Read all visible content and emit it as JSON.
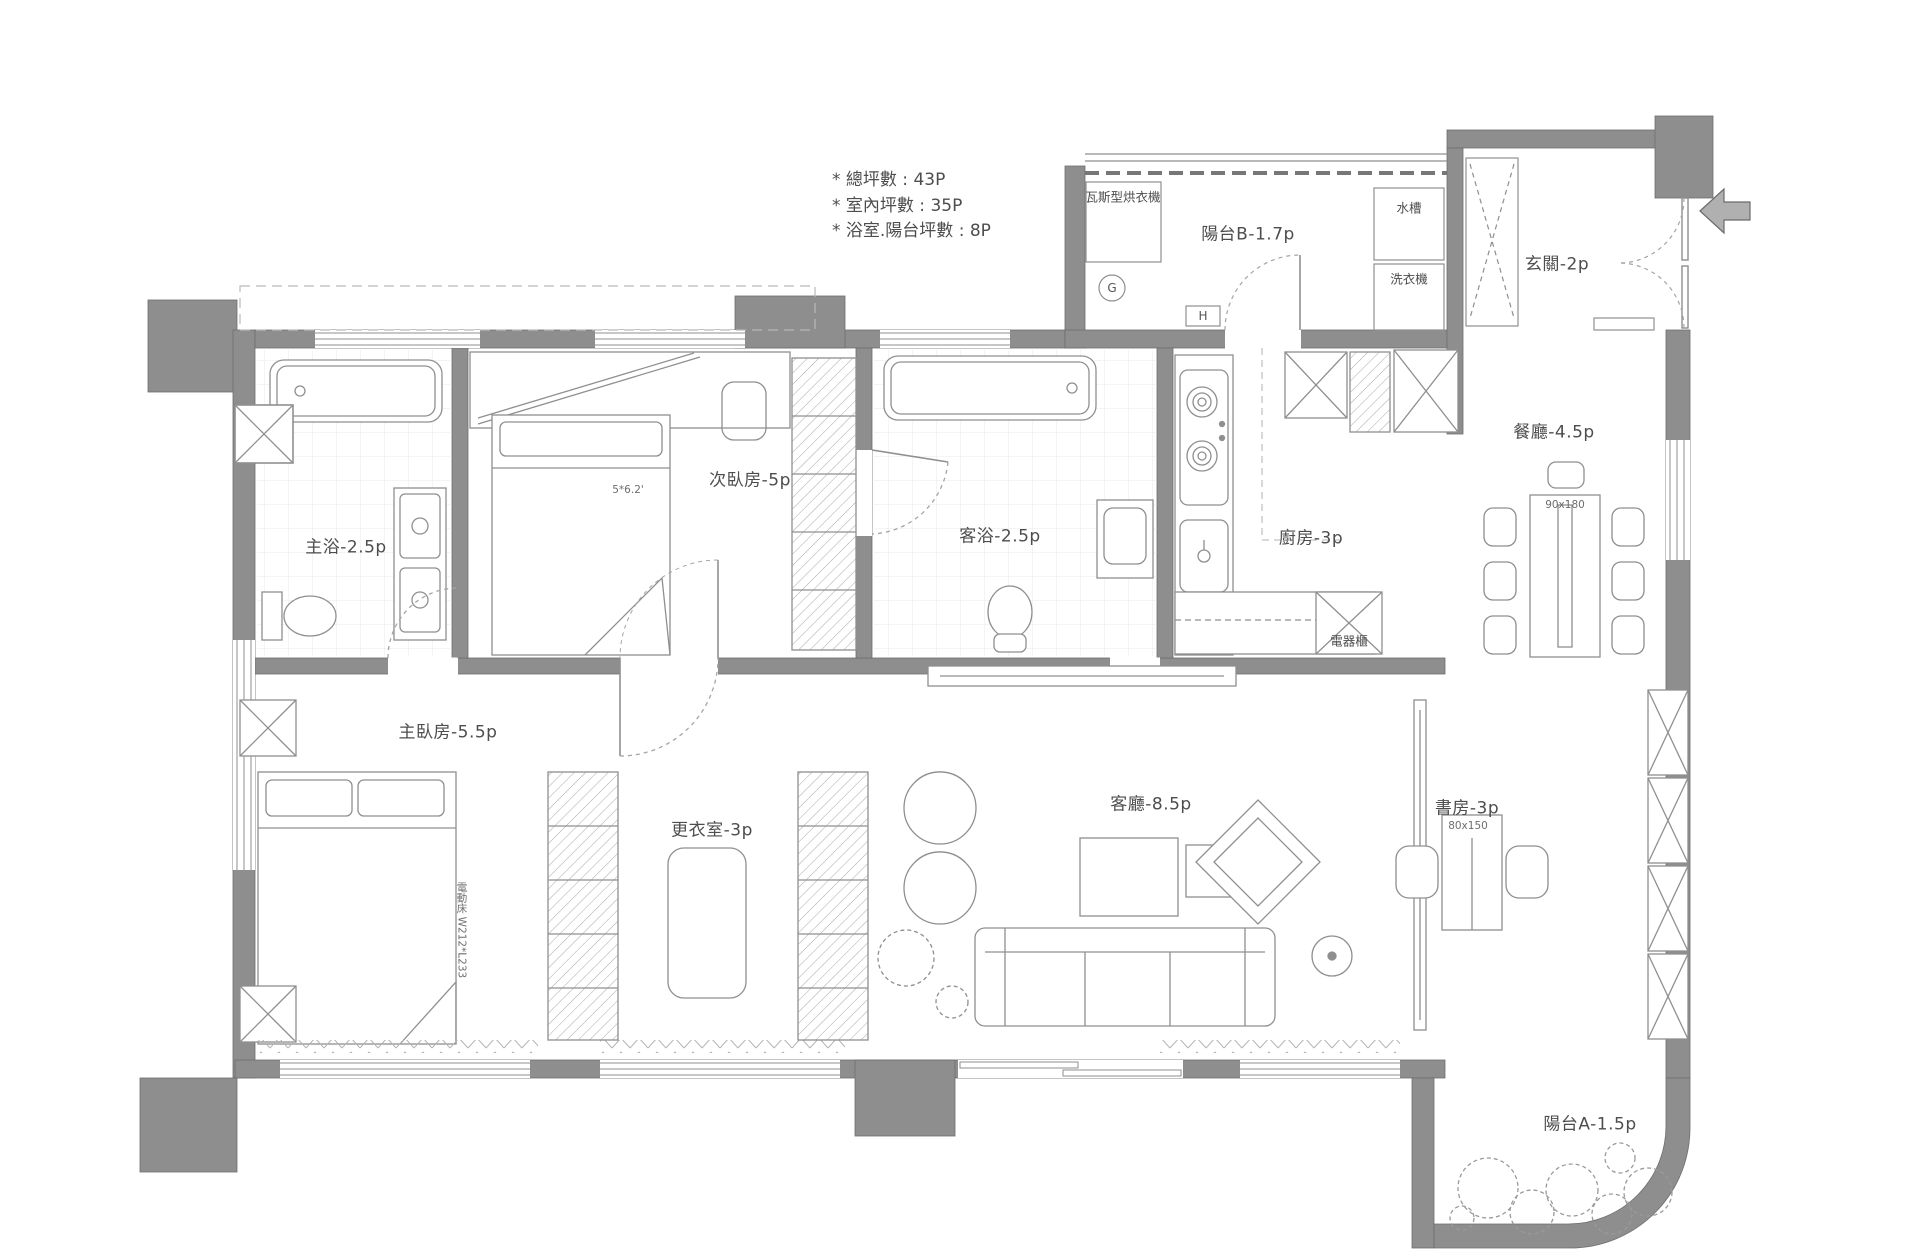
{
  "annotations": {
    "total_area": "* 總坪數 : 43P",
    "indoor_area": "* 室內坪數 : 35P",
    "bath_balcony_area": "* 浴室.陽台坪數 : 8P"
  },
  "rooms": {
    "balcony_b": "陽台B-1.7p",
    "foyer": "玄關-2p",
    "dining": "餐廳-4.5p",
    "kitchen": "廚房-3p",
    "guest_bath": "客浴-2.5p",
    "second_bedroom": "次臥房-5p",
    "master_bath": "主浴-2.5p",
    "master_bedroom": "主臥房-5.5p",
    "closet": "更衣室-3p",
    "living": "客廳-8.5p",
    "study": "書房-3p",
    "balcony_a": "陽台A-1.5p"
  },
  "fixtures": {
    "gas_dryer": "瓦斯型烘衣機",
    "sink": "水槽",
    "washer": "洗衣機",
    "appliance_cabinet": "電器櫃"
  },
  "dimensions": {
    "dining_table": "90x180",
    "desk": "80x150",
    "bed_note": "5*6.2'",
    "master_bed": "電動床 W212*L233"
  },
  "meters": {
    "gas": "G",
    "water": "H"
  },
  "colors": {
    "wall": "#8e8e8e",
    "line": "#8f8f8f",
    "text": "#4d4d4d"
  }
}
